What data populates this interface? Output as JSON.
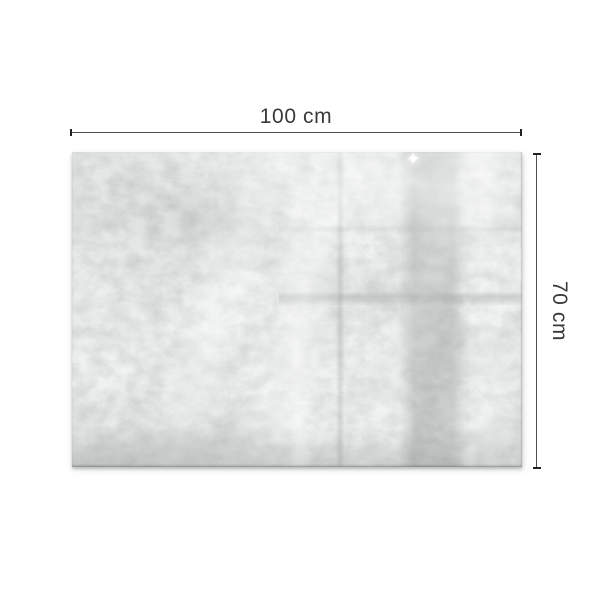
{
  "figure": {
    "subject": "Concrete texture board with dimension annotations",
    "width_dimension": {
      "label": "100 cm"
    },
    "height_dimension": {
      "label": "70 cm"
    },
    "icons": {
      "glare_sparkle": "✦"
    },
    "colors": {
      "background": "#ffffff",
      "dimension_line": "#4d4d4d",
      "dimension_cap": "#222222",
      "label_text": "#3a3a3a",
      "board_base": "#e2e5e3",
      "board_dark_band": "#c3c8c6",
      "board_shadow": "#767c79"
    }
  }
}
